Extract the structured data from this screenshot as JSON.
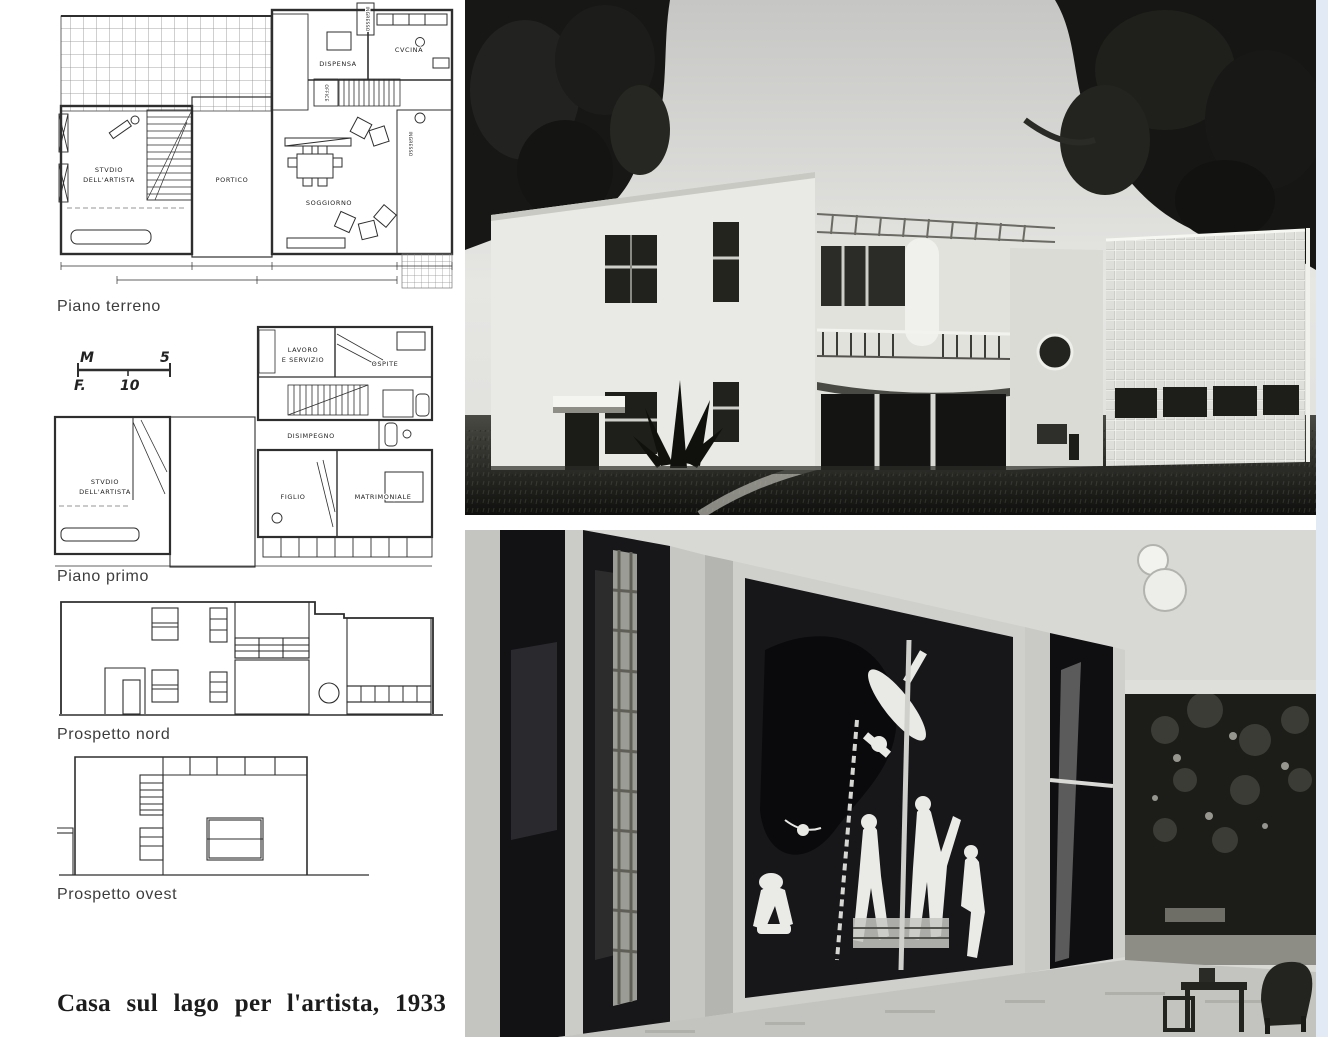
{
  "captions": {
    "ground_floor": "Piano terreno",
    "first_floor": "Piano primo",
    "north_elevation": "Prospetto nord",
    "west_elevation": "Prospetto ovest",
    "title": "Casa sul lago per l'artista, 1933"
  },
  "scale_bar": {
    "meters_label": "M",
    "meters_value": "5",
    "feet_label": "F.",
    "feet_value": "10"
  },
  "ground_floor_plan": {
    "rooms": {
      "studio_line1": "STVDIO",
      "studio_line2": "DELL'ARTISTA",
      "portico": "PORTICO",
      "soggiorno": "SOGGIORNO",
      "dispensa": "DISPENSA",
      "cucina": "CVCINA",
      "office": "OFFICE",
      "ingresso_service": "INGRESSO",
      "ingresso_main": "INGRESSO"
    }
  },
  "first_floor_plan": {
    "rooms": {
      "lavoro_line1": "LAVORO",
      "lavoro_line2": "E SERVIZIO",
      "ospite": "OSPITE",
      "disimpegno": "DISIMPEGNO",
      "studio_line1": "STVDIO",
      "studio_line2": "DELL'ARTISTA",
      "figlio": "FIGLIO",
      "matrimoniale": "MATRIMONIALE"
    }
  },
  "colors": {
    "paper": "#ffffff",
    "ink": "#2e2e2e",
    "photo_shadow": "#131311",
    "scan_edge_tint": "#dbe6f2"
  }
}
